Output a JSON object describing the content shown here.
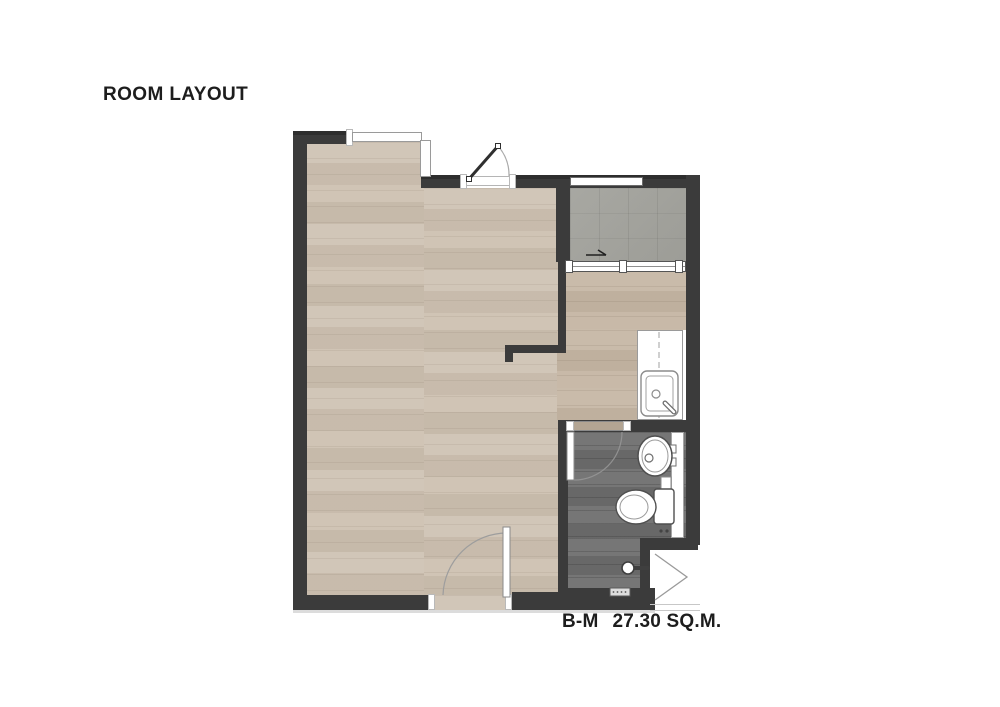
{
  "title": "ROOM LAYOUT",
  "footer": {
    "unit": "B-M",
    "area": "27.30 SQ.M."
  },
  "colors": {
    "bg": "#ffffff",
    "wall": "#3b3b3b",
    "floor_living": "#cec2b3",
    "floor_kitchen": "#c6b7a5",
    "floor_balcony": "#a3a39d",
    "floor_bath": "#6f6f6f",
    "frame_line": "#9a9a9a",
    "text": "#1d1d1d"
  }
}
